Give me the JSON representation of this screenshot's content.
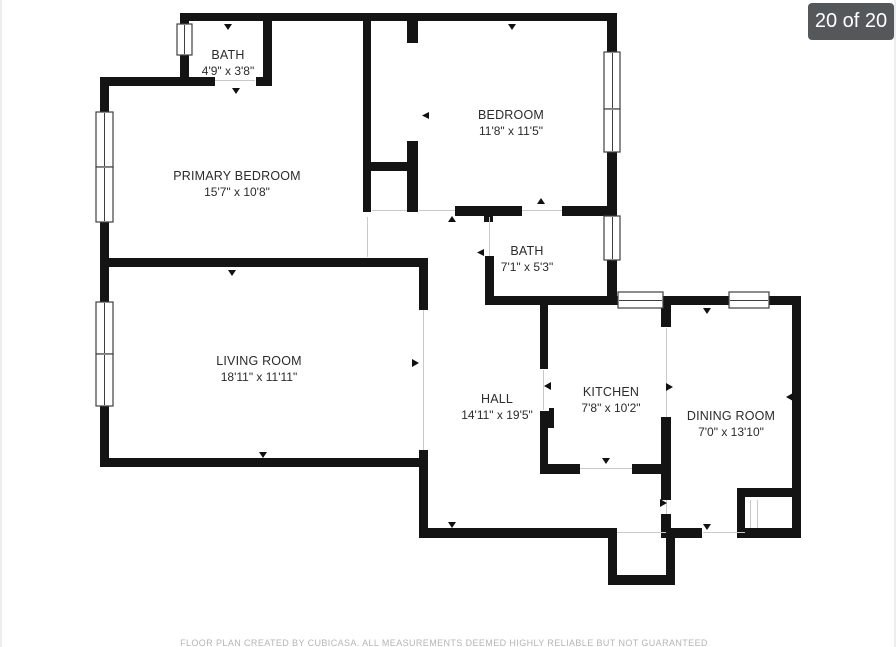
{
  "viewer": {
    "pager_badge": "20 of 20"
  },
  "floorplan": {
    "rooms": [
      {
        "name": "BATH",
        "dims": "4'9\" x 3'8\""
      },
      {
        "name": "PRIMARY BEDROOM",
        "dims": "15'7\" x 10'8\""
      },
      {
        "name": "BEDROOM",
        "dims": "11'8\" x 11'5\""
      },
      {
        "name": "BATH",
        "dims": "7'1\" x 5'3\""
      },
      {
        "name": "LIVING ROOM",
        "dims": "18'11\" x 11'11\""
      },
      {
        "name": "HALL",
        "dims": "14'11\" x 19'5\""
      },
      {
        "name": "KITCHEN",
        "dims": "7'8\" x 10'2\""
      },
      {
        "name": "DINING ROOM",
        "dims": "7'0\" x 13'10\""
      }
    ],
    "disclaimer": "FLOOR PLAN CREATED BY CUBICASA. ALL MEASUREMENTS DEEMED HIGHLY RELIABLE BUT NOT GUARANTEED"
  },
  "colors": {
    "wall": "#141414",
    "badge_bg": "#55585b",
    "badge_text": "#ffffff"
  }
}
